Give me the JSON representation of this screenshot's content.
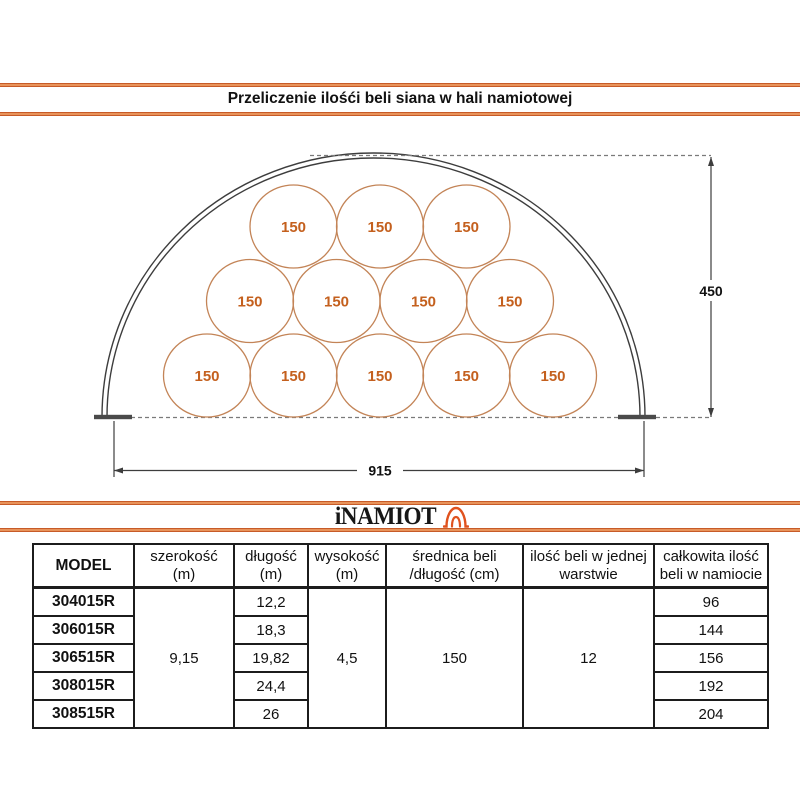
{
  "header": {
    "title": "Przeliczenie ilośći beli siana w hali namiotowej"
  },
  "diagram": {
    "bale_label": "150",
    "height_dim": "450",
    "width_dim": "915",
    "bales_top_row": 3,
    "bales_middle_row": 4,
    "bales_bottom_row": 5
  },
  "logo": {
    "text": "iNAMIOT",
    "icon": "tent-icon"
  },
  "table": {
    "headers": [
      {
        "line1": "MODEL",
        "line2": ""
      },
      {
        "line1": "szerokość",
        "line2": "(m)"
      },
      {
        "line1": "długość",
        "line2": "(m)"
      },
      {
        "line1": "wysokość",
        "line2": "(m)"
      },
      {
        "line1": "średnica beli",
        "line2": "/długość (cm)"
      },
      {
        "line1": "ilość beli w jednej",
        "line2": "warstwie"
      },
      {
        "line1": "całkowita ilość",
        "line2": "beli w namiocie"
      }
    ],
    "merged": {
      "szerokosc": "9,15",
      "wysokosc": "4,5",
      "srednica_beli": "150",
      "ilosc_beli_warstwa": "12"
    },
    "rows": [
      {
        "model": "304015R",
        "dlugosc": "12,2",
        "calkowita": "96"
      },
      {
        "model": "306015R",
        "dlugosc": "18,3",
        "calkowita": "144"
      },
      {
        "model": "306515R",
        "dlugosc": "19,82",
        "calkowita": "156"
      },
      {
        "model": "308015R",
        "dlugosc": "24,4",
        "calkowita": "192"
      },
      {
        "model": "308515R",
        "dlugosc": "26",
        "calkowita": "204"
      }
    ]
  },
  "colors": {
    "accent_orange": "#e0743c",
    "bale_stroke": "#c38457",
    "bale_text": "#c4601e"
  }
}
